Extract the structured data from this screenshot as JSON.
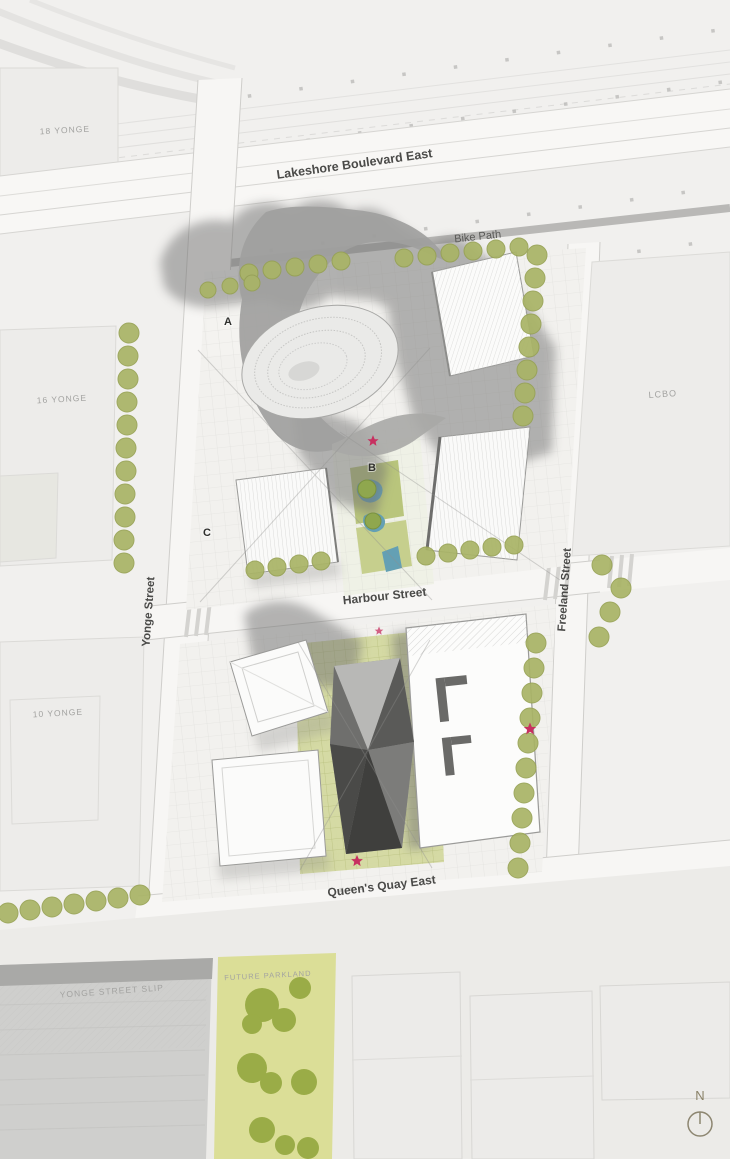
{
  "map": {
    "streets": {
      "lakeshore": "Lakeshore Boulevard East",
      "bike_path": "Bike Path",
      "harbour": "Harbour Street",
      "queens_quay": "Queen's Quay East",
      "yonge": "Yonge Street",
      "freeland": "Freeland Street",
      "yonge_slip": "YONGE STREET SLIP"
    },
    "areas": {
      "building_18_yonge": "18 YONGE",
      "building_16_yonge": "16 YONGE",
      "building_10_yonge": "10 YONGE",
      "lcbo": "LCBO",
      "future_parkland": "FUTURE PARKLAND"
    },
    "markers": {
      "a": "A",
      "b": "B",
      "c": "C"
    },
    "stars": [
      {
        "transform": "translate(373,441) scale(0.9)"
      },
      {
        "transform": "translate(379,631) scale(0.7)"
      },
      {
        "transform": "translate(530,729) scale(1.0)"
      },
      {
        "transform": "translate(357,861) scale(0.95)"
      }
    ],
    "compass": {
      "label": "N"
    },
    "colors": {
      "tree": "#a9b466",
      "tree_dark": "#8fa74e",
      "parkland": "#dbde97",
      "parkland_tree": "#94a73f",
      "water": "#64a0b4",
      "star": "#c73060"
    }
  }
}
